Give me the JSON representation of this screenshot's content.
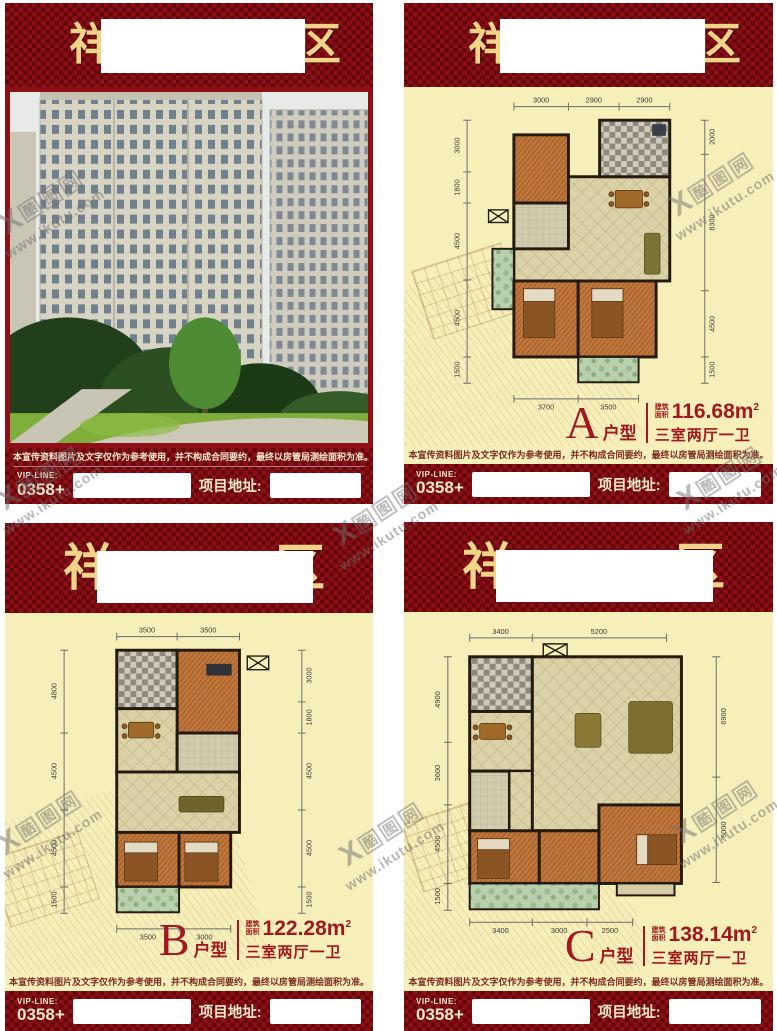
{
  "header": {
    "left_char": "祥",
    "right_char": "区"
  },
  "disclaimer": {
    "text": "本宣传资料图片及文字仅作为参考使用，并不构成合同要约，最终以房管局测绘面积为准。"
  },
  "footer": {
    "vip_label": "VIP-LINE:",
    "vip_number": "0358+",
    "address_label": "项目地址:"
  },
  "watermark": {
    "mark": "X",
    "c1": "酷",
    "c2": "图",
    "c3": "网",
    "url": "www.ikutu.com"
  },
  "colors": {
    "header_red": "#8e1016",
    "gold": "#f2d488",
    "cream": "#f6efba",
    "label_red": "#a2181e"
  },
  "plans": {
    "a": {
      "letter": "A",
      "suffix": "户型",
      "area_label_1": "建筑",
      "area_label_2": "面积",
      "area": "116.68m",
      "area_sup": "2",
      "rooms": "三室两厅一卫",
      "dims": {
        "top": [
          "3000",
          "2900",
          "2900"
        ],
        "bottom": [
          "3700",
          "3500"
        ],
        "left": [
          "3000",
          "1800",
          "4500",
          "4500",
          "1500"
        ],
        "right": [
          "2000",
          "8300",
          "4500",
          "1500"
        ]
      }
    },
    "b": {
      "letter": "B",
      "suffix": "户型",
      "area_label_1": "建筑",
      "area_label_2": "面积",
      "area": "122.28m",
      "area_sup": "2",
      "rooms": "三室两厅一卫",
      "dims": {
        "top": [
          "3500",
          "3500"
        ],
        "bottom": [
          "3500",
          "3000"
        ],
        "left": [
          "4800",
          "4500",
          "4500",
          "1500"
        ],
        "right": [
          "3000",
          "1800",
          "4500",
          "4500",
          "1500"
        ]
      }
    },
    "c": {
      "letter": "C",
      "suffix": "户型",
      "area_label_1": "建筑",
      "area_label_2": "面积",
      "area": "138.14m",
      "area_sup": "2",
      "rooms": "三室两厅一卫",
      "dims": {
        "top": [
          "3400",
          "5200"
        ],
        "bottom": [
          "3400",
          "3000",
          "2500"
        ],
        "left": [
          "4900",
          "3600",
          "4500",
          "1500"
        ],
        "right": [
          "6900",
          "6000"
        ]
      }
    }
  }
}
